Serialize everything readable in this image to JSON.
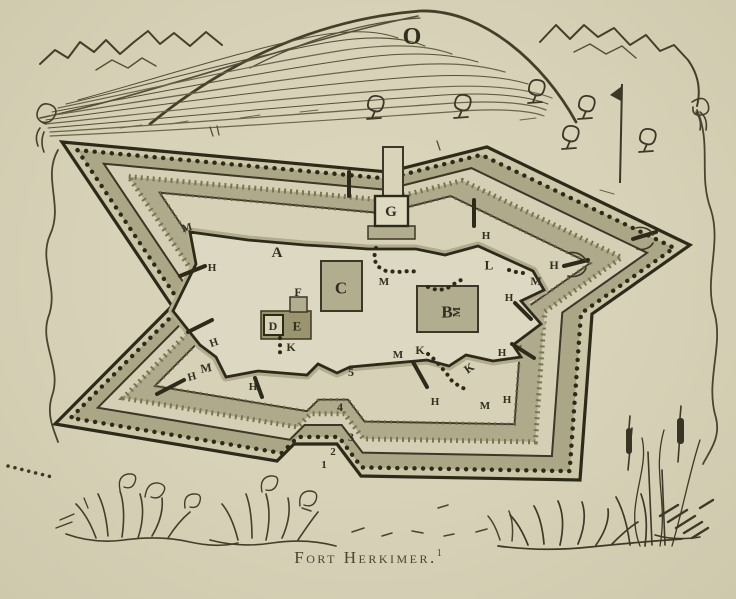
{
  "caption": {
    "text": "Fort Herkimer.",
    "footnote_marker": "1"
  },
  "plan": {
    "colors": {
      "paper": "#d8d2b9",
      "ink": "#3c3726",
      "ink_dark": "#2e2a1a",
      "works_fill": "#cdc7aa",
      "band1": "#aba686",
      "light_strip": "#d5cfb5",
      "band2": "#b0aa8c",
      "light2": "#d7d1b8",
      "parade": "#ddd8c1",
      "rampart": "#b2ac8e",
      "building": "#b3ad90",
      "building_light": "#d9d3ba",
      "building_dark": "#9a946f",
      "label": "#332f1f",
      "caption": "#4a4433"
    },
    "center": [
      372,
      303
    ],
    "outer_polygon": [
      [
        62,
        142
      ],
      [
        388,
        172
      ],
      [
        487,
        147
      ],
      [
        690,
        245
      ],
      [
        592,
        314
      ],
      [
        580,
        480
      ],
      [
        361,
        476
      ],
      [
        337,
        444
      ],
      [
        294,
        444
      ],
      [
        277,
        461
      ],
      [
        55,
        424
      ],
      [
        172,
        306
      ]
    ],
    "rings": [
      {
        "t": 0,
        "fill": "works_fill",
        "stroke": "ink_dark",
        "width": 3.2,
        "name": "outer-line"
      },
      {
        "t": 0.05,
        "fill": "band1",
        "dots": true,
        "name": "glacis-band"
      },
      {
        "t": 0.135,
        "fill": "light_strip",
        "stroke": "ink",
        "width": 2,
        "name": "covered-way-line"
      },
      {
        "t": 0.215,
        "fill": "band2",
        "fuzz": true,
        "name": "ditch-band"
      },
      {
        "t": 0.315,
        "fill": "light2",
        "stroke": "ink",
        "width": 1.8,
        "fuzz2": true,
        "name": "inner-ground-line"
      }
    ],
    "inner_wall": "M 190,232 L 248,240 L 305,245 L 340,247 L 368,249 L 416,249 L 445,255 L 478,246 L 533,271 L 544,290 L 521,301 L 541,324 L 513,345 L 521,357 L 493,361 L 466,355 L 449,366 L 427,360 L 350,367 L 337,373 L 318,364 L 307,375 L 258,371 L 226,377 L 216,357 L 200,345 L 173,311 L 196,264 Z",
    "gate": {
      "tower": [
        383,
        147,
        20,
        50
      ],
      "base": [
        368,
        226,
        47,
        13
      ],
      "box": [
        375,
        196,
        33,
        30
      ]
    },
    "buildings": [
      {
        "name": "building-C",
        "rect": [
          321,
          261,
          41,
          50
        ],
        "fill": "building",
        "stroke": "ink",
        "width": 2
      },
      {
        "name": "building-B",
        "rect": [
          417,
          286,
          61,
          46
        ],
        "fill": "building",
        "stroke": "ink",
        "width": 2
      },
      {
        "name": "building-DE",
        "rect": [
          261,
          311,
          50,
          28
        ],
        "fill": "building_dark",
        "stroke": "ink",
        "width": 1.5
      },
      {
        "name": "building-D",
        "rect": [
          264,
          315,
          19,
          20
        ],
        "fill": "building_light",
        "stroke": "ink_dark",
        "width": 2
      },
      {
        "name": "building-F",
        "rect": [
          290,
          297,
          17,
          15
        ],
        "fill": "building",
        "stroke": "ink",
        "width": 1.5
      }
    ],
    "trails": [
      [
        [
          376,
          248
        ],
        [
          374,
          258
        ],
        [
          377,
          266
        ],
        [
          386,
          271
        ],
        [
          398,
          272
        ],
        [
          410,
          271
        ],
        [
          419,
          272
        ]
      ],
      [
        [
          280,
          338
        ],
        [
          280,
          345
        ],
        [
          280,
          352
        ],
        [
          280,
          358
        ]
      ],
      [
        [
          428,
          287
        ],
        [
          437,
          290
        ],
        [
          446,
          289
        ],
        [
          454,
          284
        ],
        [
          461,
          280
        ]
      ],
      [
        [
          509,
          270
        ],
        [
          516,
          272
        ],
        [
          523,
          273
        ],
        [
          529,
          272
        ]
      ],
      [
        [
          428,
          354
        ],
        [
          435,
          360
        ],
        [
          441,
          367
        ],
        [
          447,
          374
        ],
        [
          452,
          381
        ],
        [
          459,
          386
        ],
        [
          467,
          390
        ]
      ]
    ],
    "cannons": [
      [
        180,
        276,
        205,
        266
      ],
      [
        188,
        332,
        212,
        320
      ],
      [
        157,
        394,
        184,
        380
      ],
      [
        255,
        378,
        262,
        397
      ],
      [
        413,
        362,
        427,
        387
      ],
      [
        515,
        303,
        531,
        319
      ],
      [
        512,
        344,
        534,
        358
      ],
      [
        564,
        266,
        588,
        260
      ],
      [
        633,
        239,
        656,
        232
      ],
      [
        349,
        172,
        349,
        196
      ],
      [
        474,
        200,
        474,
        226
      ]
    ],
    "trees": [
      [
        375,
        104
      ],
      [
        462,
        103
      ],
      [
        536,
        88
      ],
      [
        586,
        104
      ],
      [
        570,
        134
      ],
      [
        647,
        137
      ]
    ],
    "labels": [
      {
        "ch": "O",
        "x": 412,
        "y": 37,
        "s": 24
      },
      {
        "ch": "A",
        "x": 277,
        "y": 253,
        "s": 15
      },
      {
        "ch": "B",
        "x": 447,
        "y": 312,
        "s": 17
      },
      {
        "ch": "C",
        "x": 341,
        "y": 288,
        "s": 17
      },
      {
        "ch": "D",
        "x": 273,
        "y": 326,
        "s": 12
      },
      {
        "ch": "E",
        "x": 297,
        "y": 326,
        "s": 13
      },
      {
        "ch": "F",
        "x": 298,
        "y": 292,
        "s": 12
      },
      {
        "ch": "G",
        "x": 391,
        "y": 212,
        "s": 15
      },
      {
        "ch": "L",
        "x": 489,
        "y": 265,
        "s": 13
      },
      {
        "ch": "K",
        "x": 291,
        "y": 347,
        "s": 12
      },
      {
        "ch": "K",
        "x": 420,
        "y": 350,
        "s": 12
      },
      {
        "ch": "K",
        "x": 469,
        "y": 368,
        "s": 12,
        "rot": -35
      },
      {
        "ch": "M",
        "x": 187,
        "y": 228,
        "s": 11,
        "rot": -15
      },
      {
        "ch": "M",
        "x": 384,
        "y": 282,
        "s": 11
      },
      {
        "ch": "M",
        "x": 457,
        "y": 312,
        "s": 11,
        "rot": -90
      },
      {
        "ch": "M",
        "x": 536,
        "y": 281,
        "s": 12
      },
      {
        "ch": "M",
        "x": 398,
        "y": 355,
        "s": 11
      },
      {
        "ch": "M",
        "x": 206,
        "y": 368,
        "s": 12,
        "rot": -10
      },
      {
        "ch": "M",
        "x": 485,
        "y": 406,
        "s": 11
      },
      {
        "ch": "H",
        "x": 212,
        "y": 268,
        "s": 11
      },
      {
        "ch": "H",
        "x": 214,
        "y": 343,
        "s": 11,
        "rot": -20
      },
      {
        "ch": "H",
        "x": 192,
        "y": 377,
        "s": 11,
        "rot": -15
      },
      {
        "ch": "H",
        "x": 253,
        "y": 387,
        "s": 11
      },
      {
        "ch": "H",
        "x": 435,
        "y": 402,
        "s": 11
      },
      {
        "ch": "H",
        "x": 507,
        "y": 400,
        "s": 11
      },
      {
        "ch": "H",
        "x": 502,
        "y": 353,
        "s": 11
      },
      {
        "ch": "H",
        "x": 509,
        "y": 298,
        "s": 11
      },
      {
        "ch": "H",
        "x": 486,
        "y": 236,
        "s": 11
      },
      {
        "ch": "H",
        "x": 554,
        "y": 265,
        "s": 12
      },
      {
        "ch": "5",
        "x": 351,
        "y": 372,
        "s": 12
      },
      {
        "ch": "4",
        "x": 340,
        "y": 407,
        "s": 12
      },
      {
        "ch": "3",
        "x": 351,
        "y": 437,
        "s": 12
      },
      {
        "ch": "2",
        "x": 333,
        "y": 452,
        "s": 11
      },
      {
        "ch": "1",
        "x": 324,
        "y": 465,
        "s": 11
      }
    ]
  }
}
